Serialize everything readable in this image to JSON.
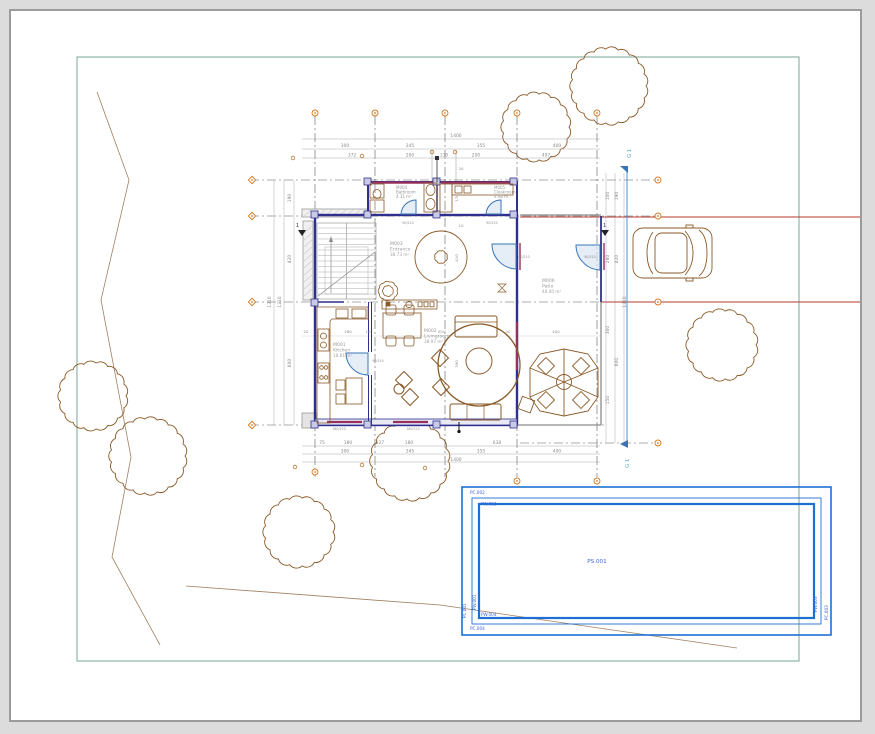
{
  "drawing": {
    "rooms": [
      {
        "id": "M001",
        "name": "Kitchen",
        "area": "18.81 m²"
      },
      {
        "id": "M002",
        "name": "Livingroom",
        "area": "38.97 m²"
      },
      {
        "id": "M003",
        "name": "Entrance",
        "area": "38.73 m²"
      },
      {
        "id": "M004",
        "name": "Bathroom",
        "area": "4.31 m²"
      },
      {
        "id": "M005",
        "name": "Cloakroom",
        "area": "4.98 m²"
      },
      {
        "id": "M006",
        "name": "Patio",
        "area": "48.40 m²"
      }
    ],
    "grid_axis_label": "G 1",
    "section_marker": "1",
    "pool": {
      "basin": "PS.001",
      "labels": {
        "top_outer": "PC.002",
        "top_inner": "PW.002",
        "bottom_inner": "PW.004",
        "bottom_outer": "PC.004",
        "left_outer": "PC.001",
        "left_inner": "PW.001",
        "right_inner": "PW.003",
        "right_outer": "PC.003"
      }
    },
    "dims": {
      "top": {
        "total": "1400",
        "row2": [
          "300",
          "345",
          "355",
          "400"
        ],
        "row3": [
          "372",
          "200",
          "130",
          "200",
          "497"
        ]
      },
      "bottom": {
        "row1": [
          "75",
          "180",
          "127",
          "180",
          "638"
        ],
        "row2": [
          "300",
          "345",
          "355",
          "400"
        ],
        "total": "1400"
      },
      "left": {
        "values": [
          "190",
          "420",
          "600"
        ],
        "totals": [
          "1210",
          "1310"
        ]
      },
      "right": {
        "inner": [
          "100",
          "280",
          "300",
          "150"
        ],
        "outer": [
          "190",
          "420",
          "600"
        ],
        "total": "1310"
      },
      "interior_h": [
        "20",
        "280",
        "10",
        "610",
        "20",
        "400"
      ],
      "interior_v": [
        "20",
        "170",
        "10",
        "410",
        "390"
      ]
    },
    "tags": {
      "door": "90/210",
      "window": "180/120"
    },
    "colors": {
      "wall_navy": "#2f2f8f",
      "window_crimson": "#97305a",
      "furniture_brown": "#8a5a28",
      "terrain": "#a08060",
      "pool_blue": "#1e6fd4",
      "boundary_teal": "#84aca0",
      "axis_orange": "#d4791f",
      "section_red": "#b8382e",
      "door_blue": "#3a76b5",
      "grid_gray": "#5a5a5a",
      "background": "#dcdcdc"
    }
  }
}
